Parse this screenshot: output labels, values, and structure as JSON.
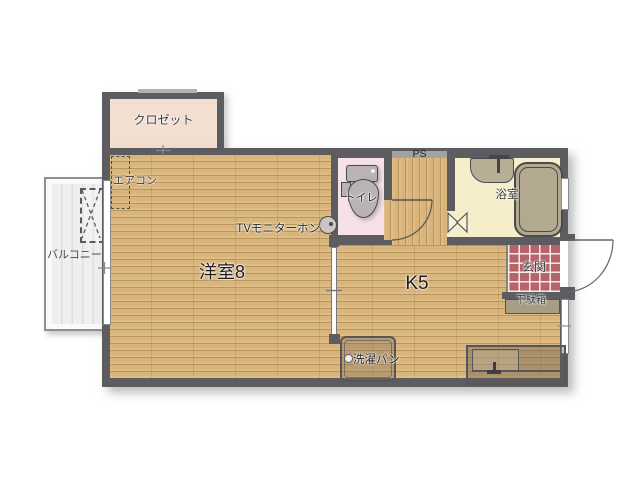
{
  "plan": {
    "type": "japanese-apartment-floor-plan",
    "balcony": {
      "label": "バルコニー"
    },
    "closet": {
      "label": "クロゼット"
    },
    "aircon": {
      "label": "エアコン"
    },
    "western_room": {
      "label": "洋室8"
    },
    "intercom": {
      "label": "TVモニターホン"
    },
    "toilet": {
      "label": "トイレ"
    },
    "pipe_space": {
      "label": "PS"
    },
    "bathroom": {
      "label": "浴室"
    },
    "kitchen": {
      "label": "K5"
    },
    "entrance": {
      "label": "玄関"
    },
    "shoe_cabinet": {
      "label": "下駄箱"
    },
    "laundry_pan": {
      "label": "洗濯パン"
    }
  },
  "icons": {
    "toilet": "toilet-icon",
    "bathtub": "bathtub-icon",
    "bath_sink": "sink-icon",
    "kitchen_sink": "kitchen-sink-icon",
    "intercom": "doorbell-circle-icon",
    "outdoor_unit": "ac-outdoor-unit-dashed-box",
    "aircon": "ac-indoor-unit-dashed-box",
    "doors": [
      "entry-door-swing-arc",
      "toilet-door-swing-arc",
      "bathroom-folding-door"
    ]
  },
  "colors": {
    "wall": "#5d5d61",
    "wood_floor": "#d9b57b",
    "closet_floor": "#f3ded2",
    "toilet_floor": "#f6e1e6",
    "bathroom_floor": "#f6eecb",
    "bathtub": "#b2a990",
    "entrance_tile": "#b5656a",
    "balcony_floor": "#f0f0f0",
    "shoe_cabinet": "#a89e83"
  }
}
